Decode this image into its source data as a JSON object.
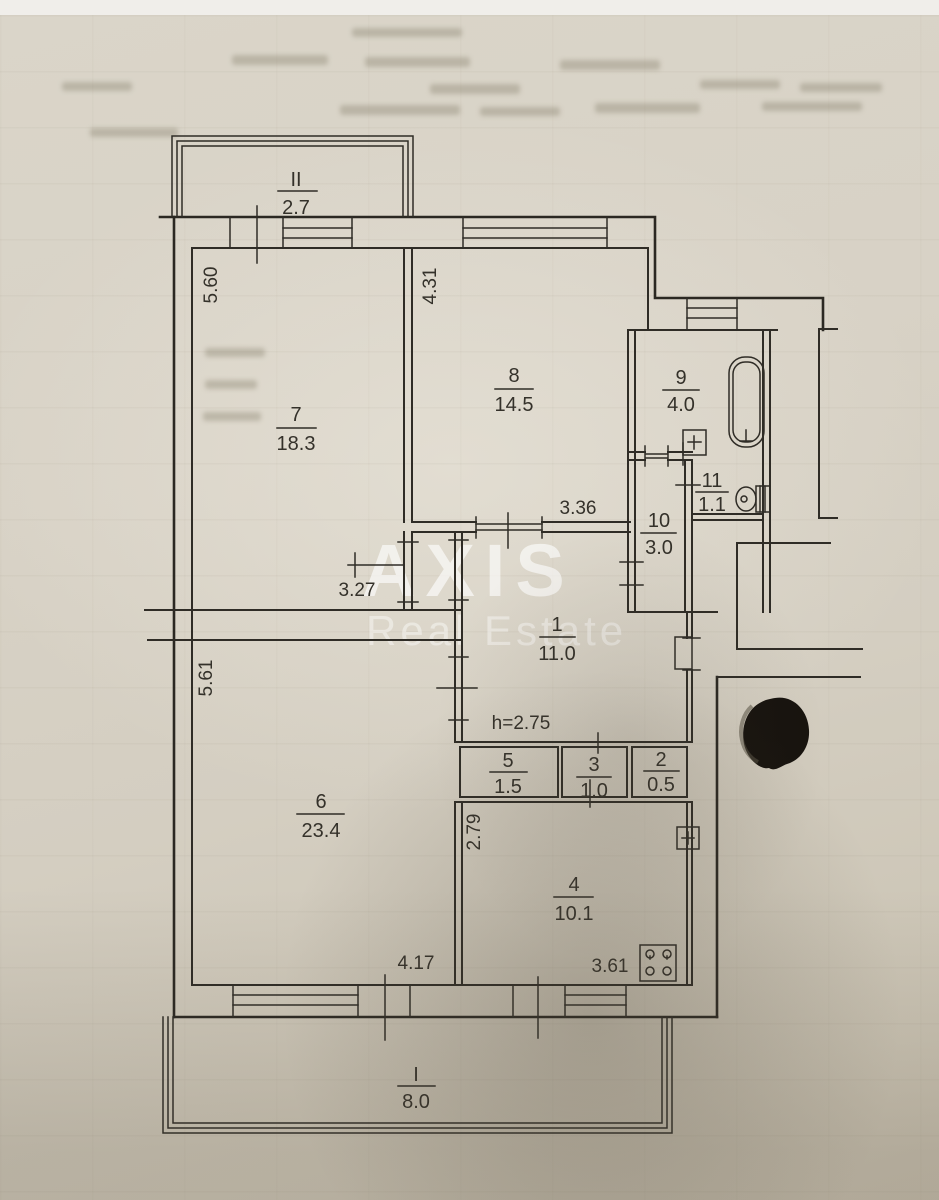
{
  "watermark": {
    "line1": "AXIS",
    "line2": "Real Estate"
  },
  "rooms": [
    {
      "number": "7",
      "area": "18.3"
    },
    {
      "number": "8",
      "area": "14.5"
    },
    {
      "number": "9",
      "area": "4.0"
    },
    {
      "number": "10",
      "area": "3.0"
    },
    {
      "number": "11",
      "area": "1.1"
    },
    {
      "number": "1",
      "area": "11.0"
    },
    {
      "number": "5",
      "area": "1.5"
    },
    {
      "number": "3",
      "area": "1.0"
    },
    {
      "number": "2",
      "area": "0.5"
    },
    {
      "number": "6",
      "area": "23.4"
    },
    {
      "number": "4",
      "area": "10.1"
    }
  ],
  "balconies": [
    {
      "number": "II",
      "area": "2.7"
    },
    {
      "number": "I",
      "area": "8.0"
    }
  ],
  "dims": {
    "d560": "5.60",
    "d431": "4.31",
    "d327": "3.27",
    "d336": "3.36",
    "d561": "5.61",
    "d279": "2.79",
    "d417": "4.17",
    "d361": "3.61",
    "height": "h=2.75"
  },
  "fixtures": {
    "bathtub": "bathtub",
    "toilet": "toilet",
    "stove": "stove",
    "junction_box": "junction-box"
  }
}
